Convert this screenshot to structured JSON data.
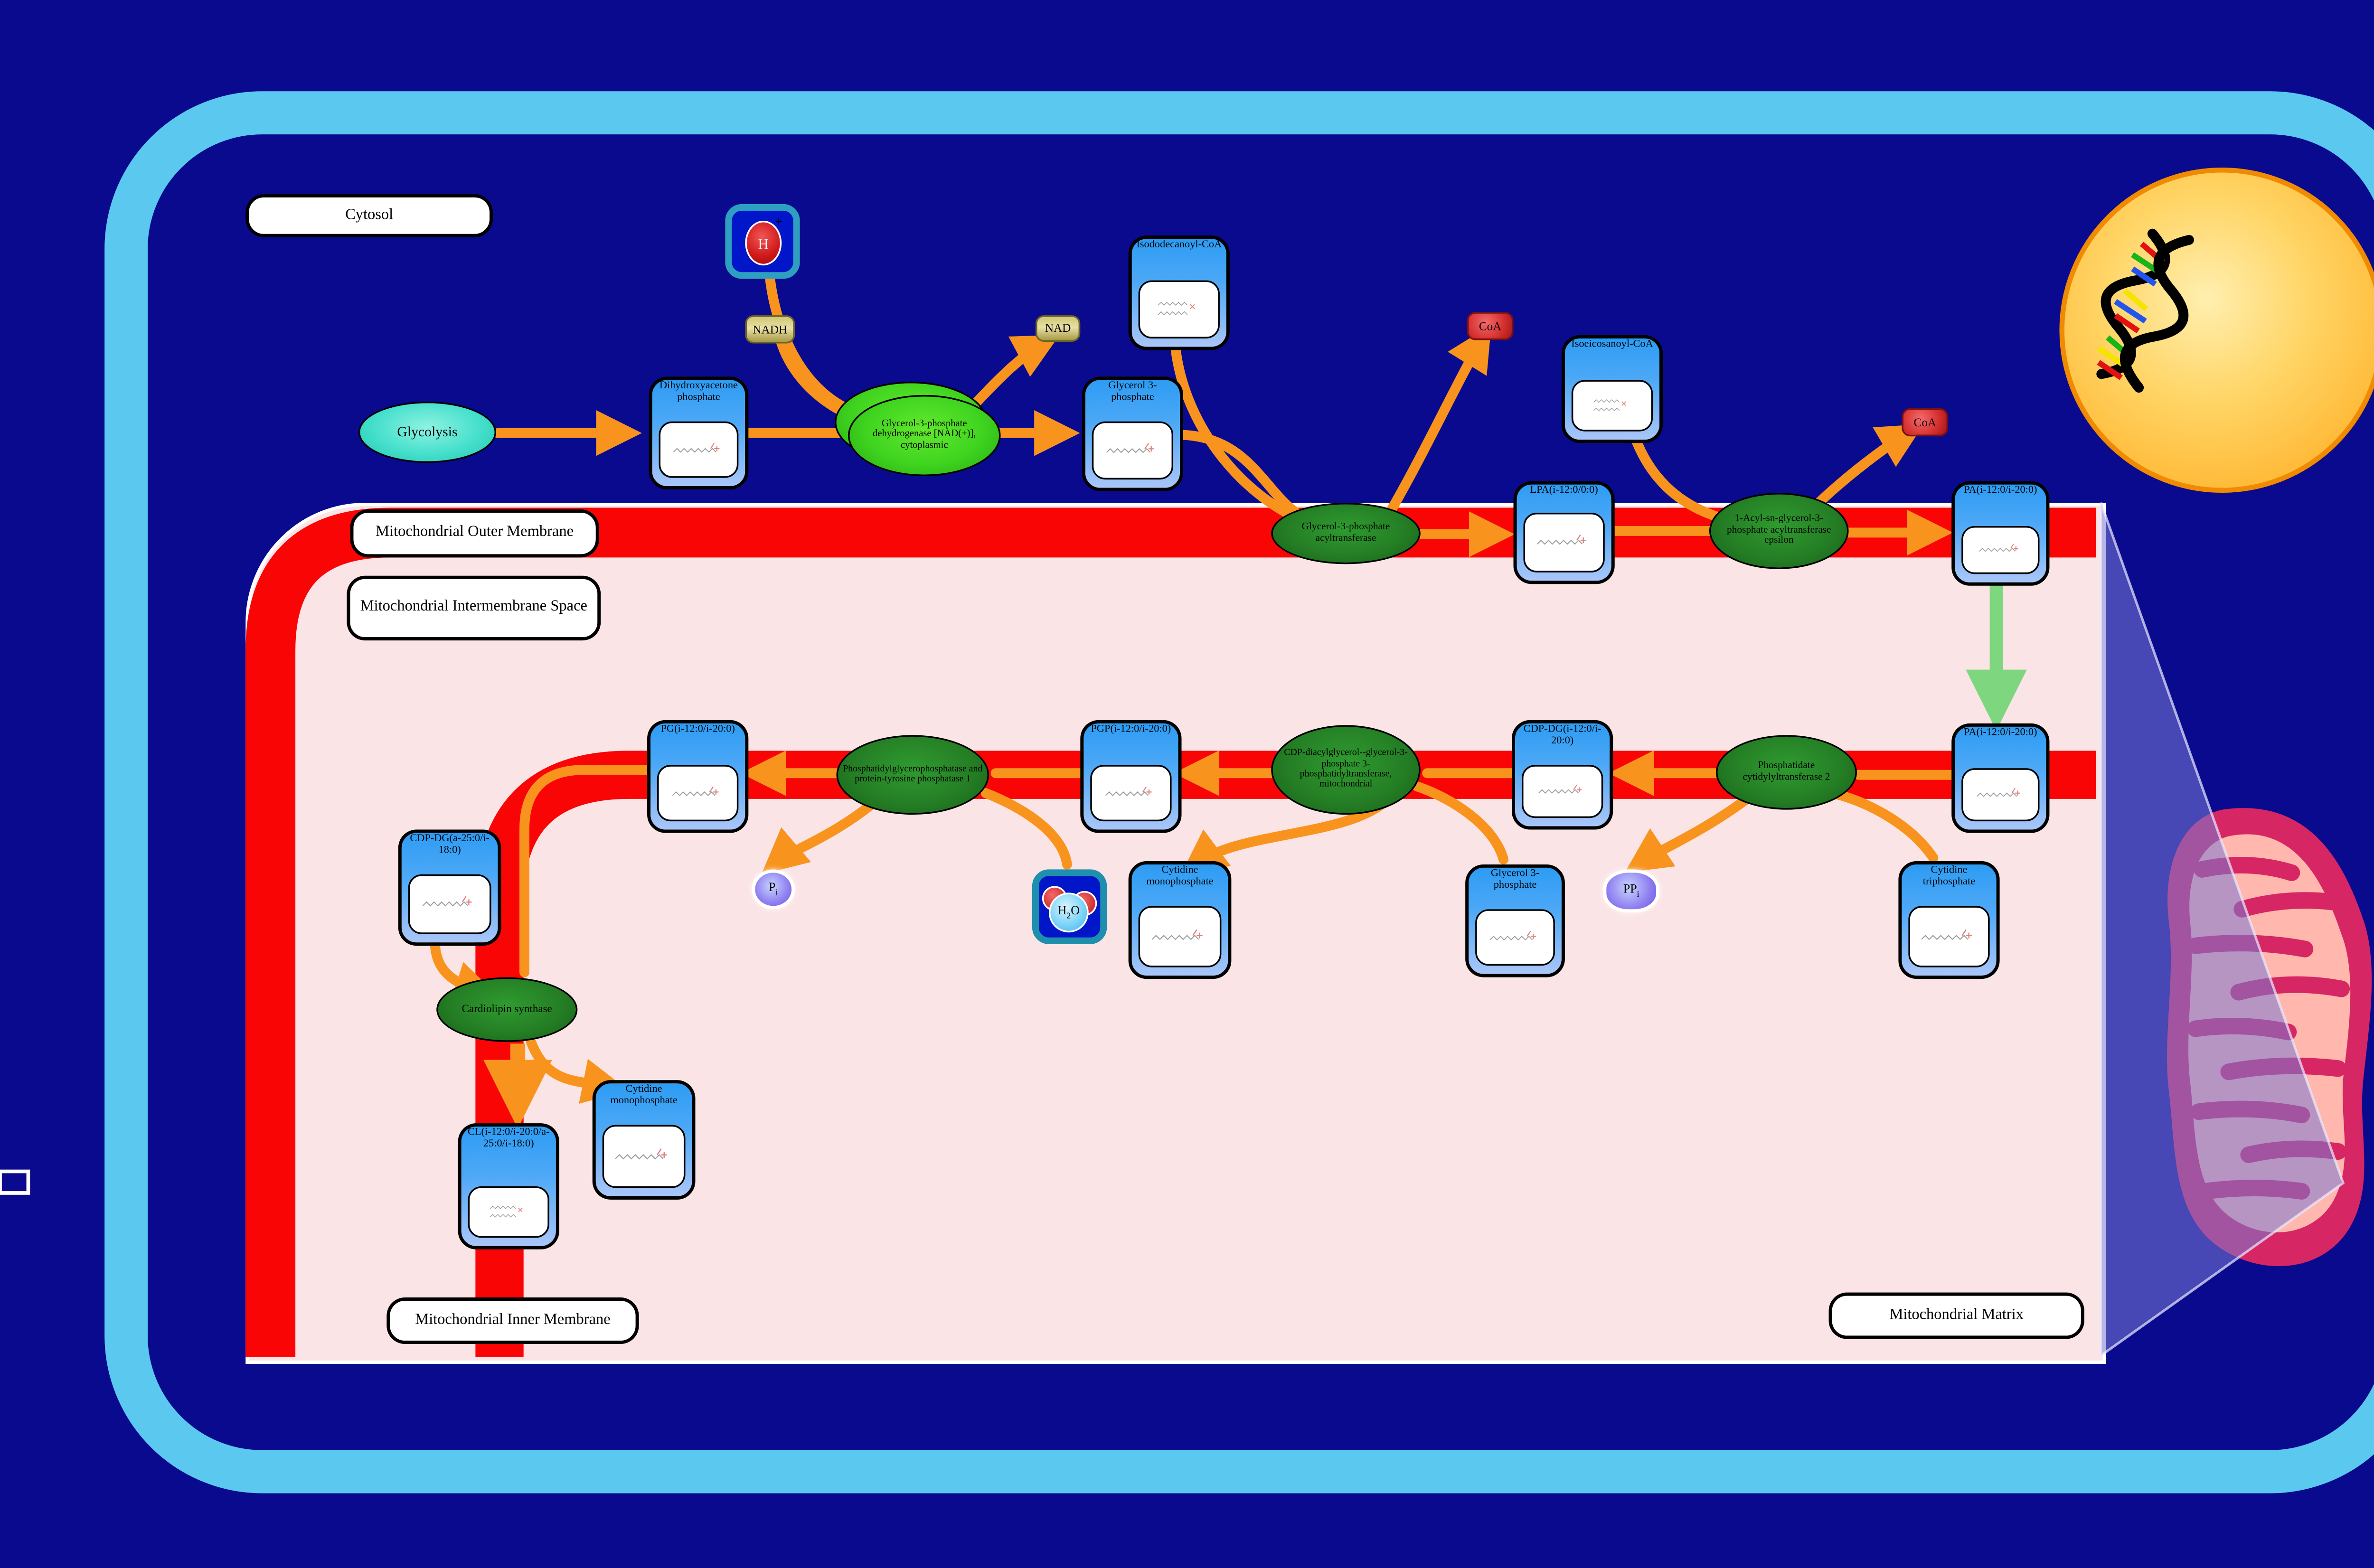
{
  "compartments": {
    "cytosol": "Cytosol",
    "outer_membrane": "Mitochondrial Outer Membrane",
    "intermembrane_space": "Mitochondrial Intermembrane Space",
    "inner_membrane": "Mitochondrial Inner Membrane",
    "matrix": "Mitochondrial Matrix"
  },
  "pathways": {
    "glycolysis": "Glycolysis"
  },
  "metabolites": {
    "dhap": {
      "label": "Dihydroxyacetone phosphate"
    },
    "g3p": {
      "label": "Glycerol 3-phosphate"
    },
    "isododecanoyl": {
      "label": "Isododecanoyl-CoA"
    },
    "isoeicosanoyl": {
      "label": "Isoeicosanoyl-CoA"
    },
    "lpa": {
      "label": "LPA(i-12:0/0:0)"
    },
    "pa": {
      "label": "PA(i-12:0/i-20:0)"
    },
    "cdp_dg": {
      "label": "CDP-DG(i-12:0/i-20:0)"
    },
    "pgp": {
      "label": "PGP(i-12:0/i-20:0)"
    },
    "pg": {
      "label": "PG(i-12:0/i-20:0)"
    },
    "ctp": {
      "label": "Cytidine triphosphate"
    },
    "cmp": {
      "label": "Cytidine monophosphate"
    },
    "cdp_dg_a": {
      "label": "CDP-DG(a-25:0/i-18:0)"
    },
    "cl": {
      "label": "CL(i-12:0/i-20:0/a-25:0/i-18:0)"
    }
  },
  "enzymes": {
    "gpd": {
      "label": "Glycerol-3-phosphate dehydrogenase [NAD(+)], cytoplasmic"
    },
    "gpat": {
      "label": "Glycerol-3-phosphate acyltransferase"
    },
    "agpat_e": {
      "label": "1-Acyl-sn-glycerol-3-phosphate acyltransferase epsilon"
    },
    "pcyt2": {
      "label": "Phosphatidate cytidylyltransferase 2"
    },
    "cdp_dgs": {
      "label": "CDP-diacylglycerol--glycerol-3-phosphate 3-phosphatidyltransferase, mitochondrial"
    },
    "pgp_ptp1": {
      "label": "Phosphatidylglycerophosphatase and protein-tyrosine phosphatase 1"
    },
    "cls": {
      "label": "Cardiolipin synthase"
    }
  },
  "small_molecules": {
    "nadh": "NADH",
    "nad": "NAD",
    "coa": "CoA",
    "h_plus": {
      "base": "H",
      "sup": "+"
    },
    "water": {
      "h": "H",
      "sub": "2",
      "o": "O"
    },
    "pi": {
      "base": "P",
      "sub": "i"
    },
    "ppi": {
      "base": "PP",
      "sub": "i"
    }
  },
  "colors": {
    "navy": "#0a0a8f",
    "cell_border": "#5bc8ef",
    "membrane_red": "#f90505",
    "matrix_pink": "#fbe4e6",
    "arrow_orange": "#f8941e",
    "arrow_green": "#7ed67e",
    "box_blue": "#2d9cf4",
    "enzyme_green_dark": "#217821",
    "enzyme_green_bright": "#3fd41f",
    "nucleus_orange": "#ffb733",
    "mito_crimson": "#d62663",
    "mito_pink": "#ffb7ae",
    "wedge_purple": "#7a7ad6"
  }
}
